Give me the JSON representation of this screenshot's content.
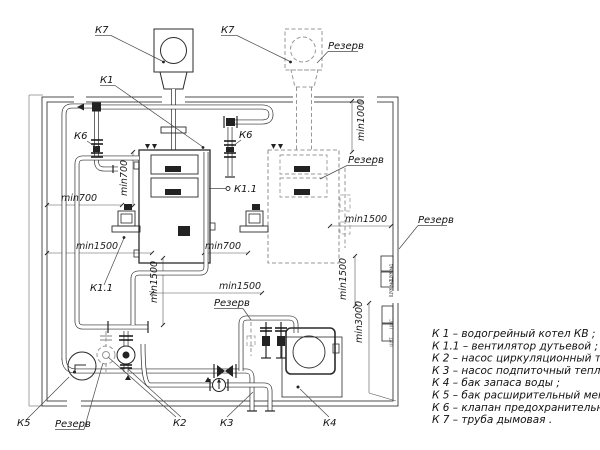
{
  "labels": {
    "k7_left": "К7",
    "k7_right": "К7",
    "k1": "К1",
    "k6_left": "К6",
    "k6_right": "К6",
    "k11_right": "К1.1",
    "k11_left": "К1.1",
    "k2": "К2",
    "k3": "К3",
    "k4": "К4",
    "k5": "К5",
    "reserve_chimney": "Резерв",
    "reserve_boiler": "Резерв",
    "reserve_wall": "Резерв",
    "reserve_makeup": "Резерв",
    "reserve_pump": "Резерв"
  },
  "dimensions": {
    "left_h_700": "min700",
    "left_v_700": "min700",
    "left_h_1500": "min1500",
    "center_h_700": "min700",
    "center_h_1500": "min1500",
    "center_v_1500": "min1500",
    "right_v_1000": "min1000",
    "right_h_1500": "min1500",
    "right_v_1500": "min1500",
    "right_v_3000": "min3000"
  },
  "cabinets": [
    "ЩУК №1",
    "ЩУК №2",
    "ШУС",
    "ЩУТ"
  ],
  "legend": {
    "items": [
      "К 1 –  водогрейный котел КВ ;",
      "К 1.1 –  вентилятор дутьевой ;",
      "К 2 –  насос циркуляционный теплосети ;",
      "К 3 –  насос подпиточный теплосети ;",
      "К 4 –  бак запаса воды ;",
      "К 5 –  бак расширительный мембранный ;",
      "К 6 –  клапан предохранительный ;",
      "К 7 –  труба дымовая ."
    ]
  }
}
